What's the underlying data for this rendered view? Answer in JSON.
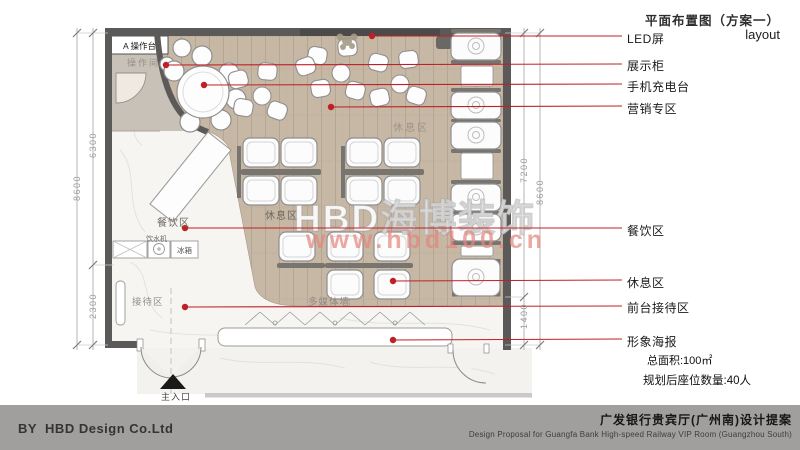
{
  "title": {
    "cn": "平面布置图（方案一）",
    "en": "layout"
  },
  "callouts": {
    "led": "LED屏",
    "display_cabinet": "展示柜",
    "phone_charging": "手机充电台",
    "marketing_zone": "营销专区",
    "dining_zone": "餐饮区",
    "rest_zone": "休息区",
    "front_desk": "前台接待区",
    "image_poster": "形象海报"
  },
  "stats": {
    "area": "总面积:100㎡",
    "seats": "规划后座位数量:40人"
  },
  "plan_labels": {
    "op_counter": "A 操作台",
    "op_room": "操作间",
    "rest_top": "休息区",
    "rest_center": "休息区",
    "dining": "餐饮区",
    "reception": "接待区",
    "media_wall": "多媒体墙",
    "main_entrance": "主入口",
    "water_dispenser": "饮水机",
    "fridge": "冰箱"
  },
  "dimensions": {
    "left_total": "8600",
    "left_upper": "6300",
    "left_lower": "2300",
    "right_upper": "7200",
    "right_lower": "1400",
    "right_total": "8600"
  },
  "watermark": {
    "brand": "HBD海博装饰",
    "url": "www.hbd100.cn"
  },
  "footer": {
    "credit": "BY  HBD Design Co.Ltd",
    "project_cn": "广发银行贵宾厅(广州南)设计提案",
    "project_en": "Design Proposal for Guangfa Bank High-speed Railway VIP Room (Guangzhou South)"
  },
  "colors": {
    "leader_red": "#bf2026",
    "wall_gray": "#5c5a58",
    "wood_floor": "#c7b8a6",
    "footer_bar": "#a09f9d"
  }
}
